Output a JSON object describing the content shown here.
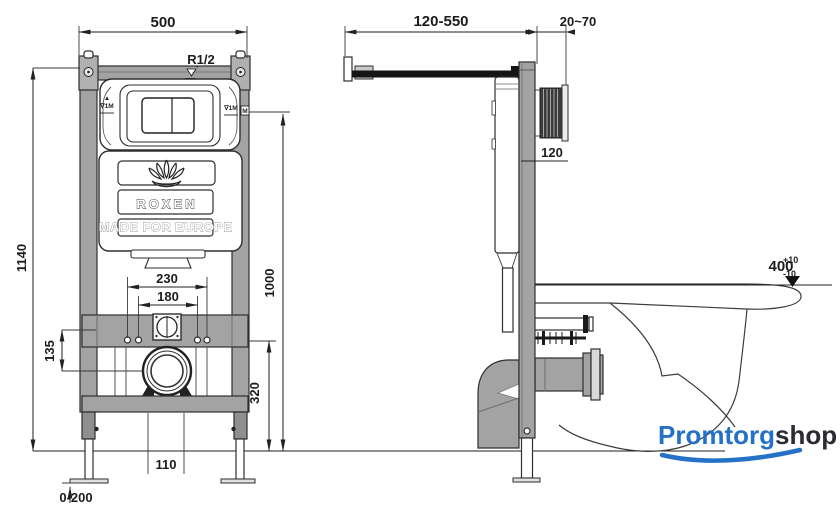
{
  "drawing": {
    "title_semantic": "wall-hung toilet installation frame technical drawing",
    "brand": {
      "logo_text": "ROXEN",
      "tagline": "MADE FOR EUROPE"
    },
    "front_view": {
      "dim_width": "500",
      "dim_height": "1140",
      "dim_bolt_outer": "230",
      "dim_bolt_inner": "180",
      "dim_inlet_to_drain": "135",
      "dim_drain_height": "320",
      "dim_plate_height": "1000",
      "dim_outlet_gap": "110",
      "dim_leg_adjust": "0-200",
      "label_inlet_thread": "R1/2",
      "label_level_left": "∇1M",
      "label_level_left_mark": "▲",
      "label_level_right": "∇1M",
      "label_m_mark": "M"
    },
    "side_view": {
      "dim_bracket_range": "120-550",
      "dim_wall_thickness": "20~70",
      "dim_plate_offset": "120",
      "dim_bowl_height": "400",
      "dim_bowl_tol_plus": "+10",
      "dim_bowl_tol_minus": "-10"
    },
    "watermark": {
      "part1": "Promtorg",
      "part2": "shop"
    },
    "colors": {
      "frame_gray": "#a3a3a3",
      "line_dark": "#222222",
      "brand_blue": "#2471c7",
      "brand_dark": "#2b2b33"
    }
  }
}
